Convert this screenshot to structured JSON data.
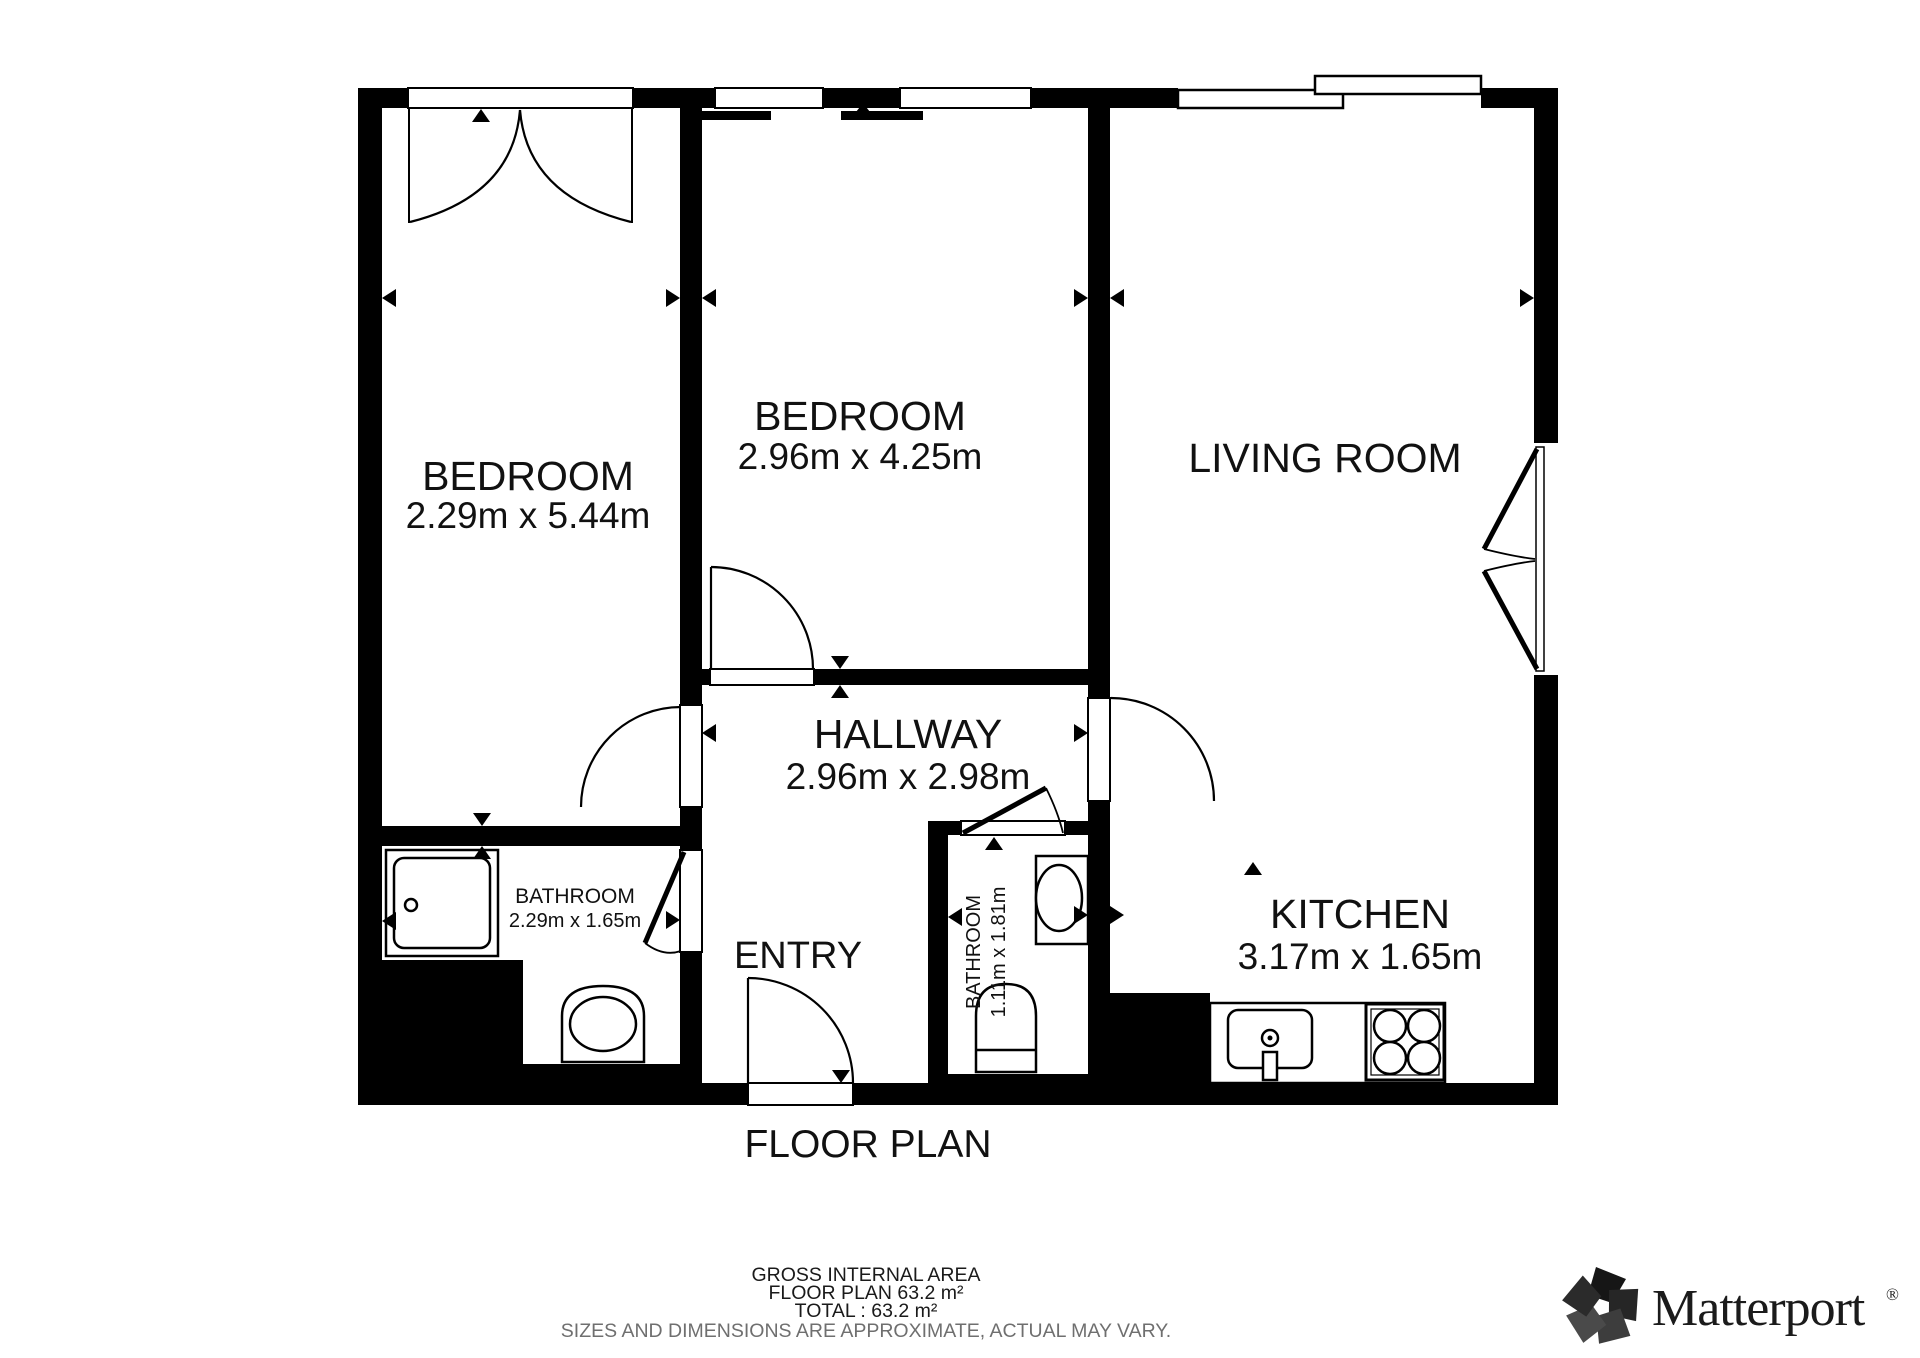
{
  "title": "FLOOR PLAN",
  "rooms": {
    "bedroom1": {
      "name": "BEDROOM",
      "dims": "2.29m x 5.44m"
    },
    "bedroom2": {
      "name": "BEDROOM",
      "dims": "2.96m x 4.25m"
    },
    "living": {
      "name": "LIVING ROOM"
    },
    "hallway": {
      "name": "HALLWAY",
      "dims": "2.96m x 2.98m"
    },
    "bathroom1": {
      "name": "BATHROOM",
      "dims": "2.29m x 1.65m"
    },
    "bathroom2": {
      "name": "BATHROOM",
      "dims": "1.11m x 1.81m"
    },
    "entry": {
      "name": "ENTRY"
    },
    "kitchen": {
      "name": "KITCHEN",
      "dims": "3.17m x 1.65m"
    }
  },
  "footer": {
    "gross_internal_area": "GROSS INTERNAL AREA",
    "floor_plan_area": "FLOOR PLAN 63.2 m²",
    "total_area": "TOTAL :  63.2 m²",
    "disclaimer": "SIZES AND DIMENSIONS ARE APPROXIMATE, ACTUAL MAY VARY."
  },
  "brand": {
    "name": "Matterport",
    "registered": "®"
  },
  "colors": {
    "wall": "#000000",
    "disclaimer_gray": "#6f6f6f",
    "logo_text": "#1b1b1b"
  }
}
